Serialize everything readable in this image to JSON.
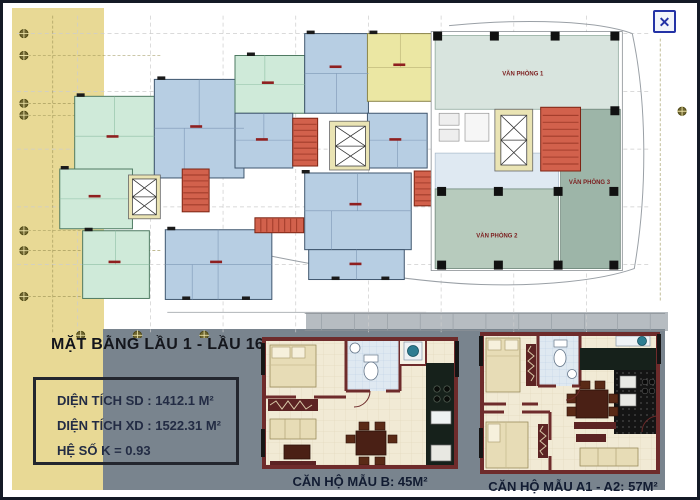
{
  "window": {
    "close_icon": "✕"
  },
  "floor_plan": {
    "title": "MẶT BẰNG LẦU 1 - LẦU 16",
    "office_labels": [
      "VĂN PHÒNG 1",
      "VĂN PHÒNG 2",
      "VĂN PHÒNG 3"
    ]
  },
  "info_box": {
    "lines": [
      "DIỆN TÍCH SD : 1412.1 M²",
      "DIỆN TÍCH XD : 1522.31 M²",
      "HỆ SỐ K = 0.93"
    ]
  },
  "unit_plans": [
    {
      "caption": "CĂN HỘ MẪU B: 45M²"
    },
    {
      "caption": "CĂN HỘ MẪU A1 - A2: 57M²"
    }
  ],
  "colors": {
    "strip_beige": "#e8d995",
    "panel_gray": "#79848e",
    "apartment_blue": "#b7cee3",
    "apartment_mint": "#cfead9",
    "apartment_yellow": "#ebe7a3",
    "stair_red": "#d2614c",
    "office_light": "#d8e4de",
    "office_mid": "#b7cbbd",
    "office_dark": "#9db5a8",
    "wall_maroon": "#6e2b2b",
    "close_blue": "#2433a6"
  }
}
